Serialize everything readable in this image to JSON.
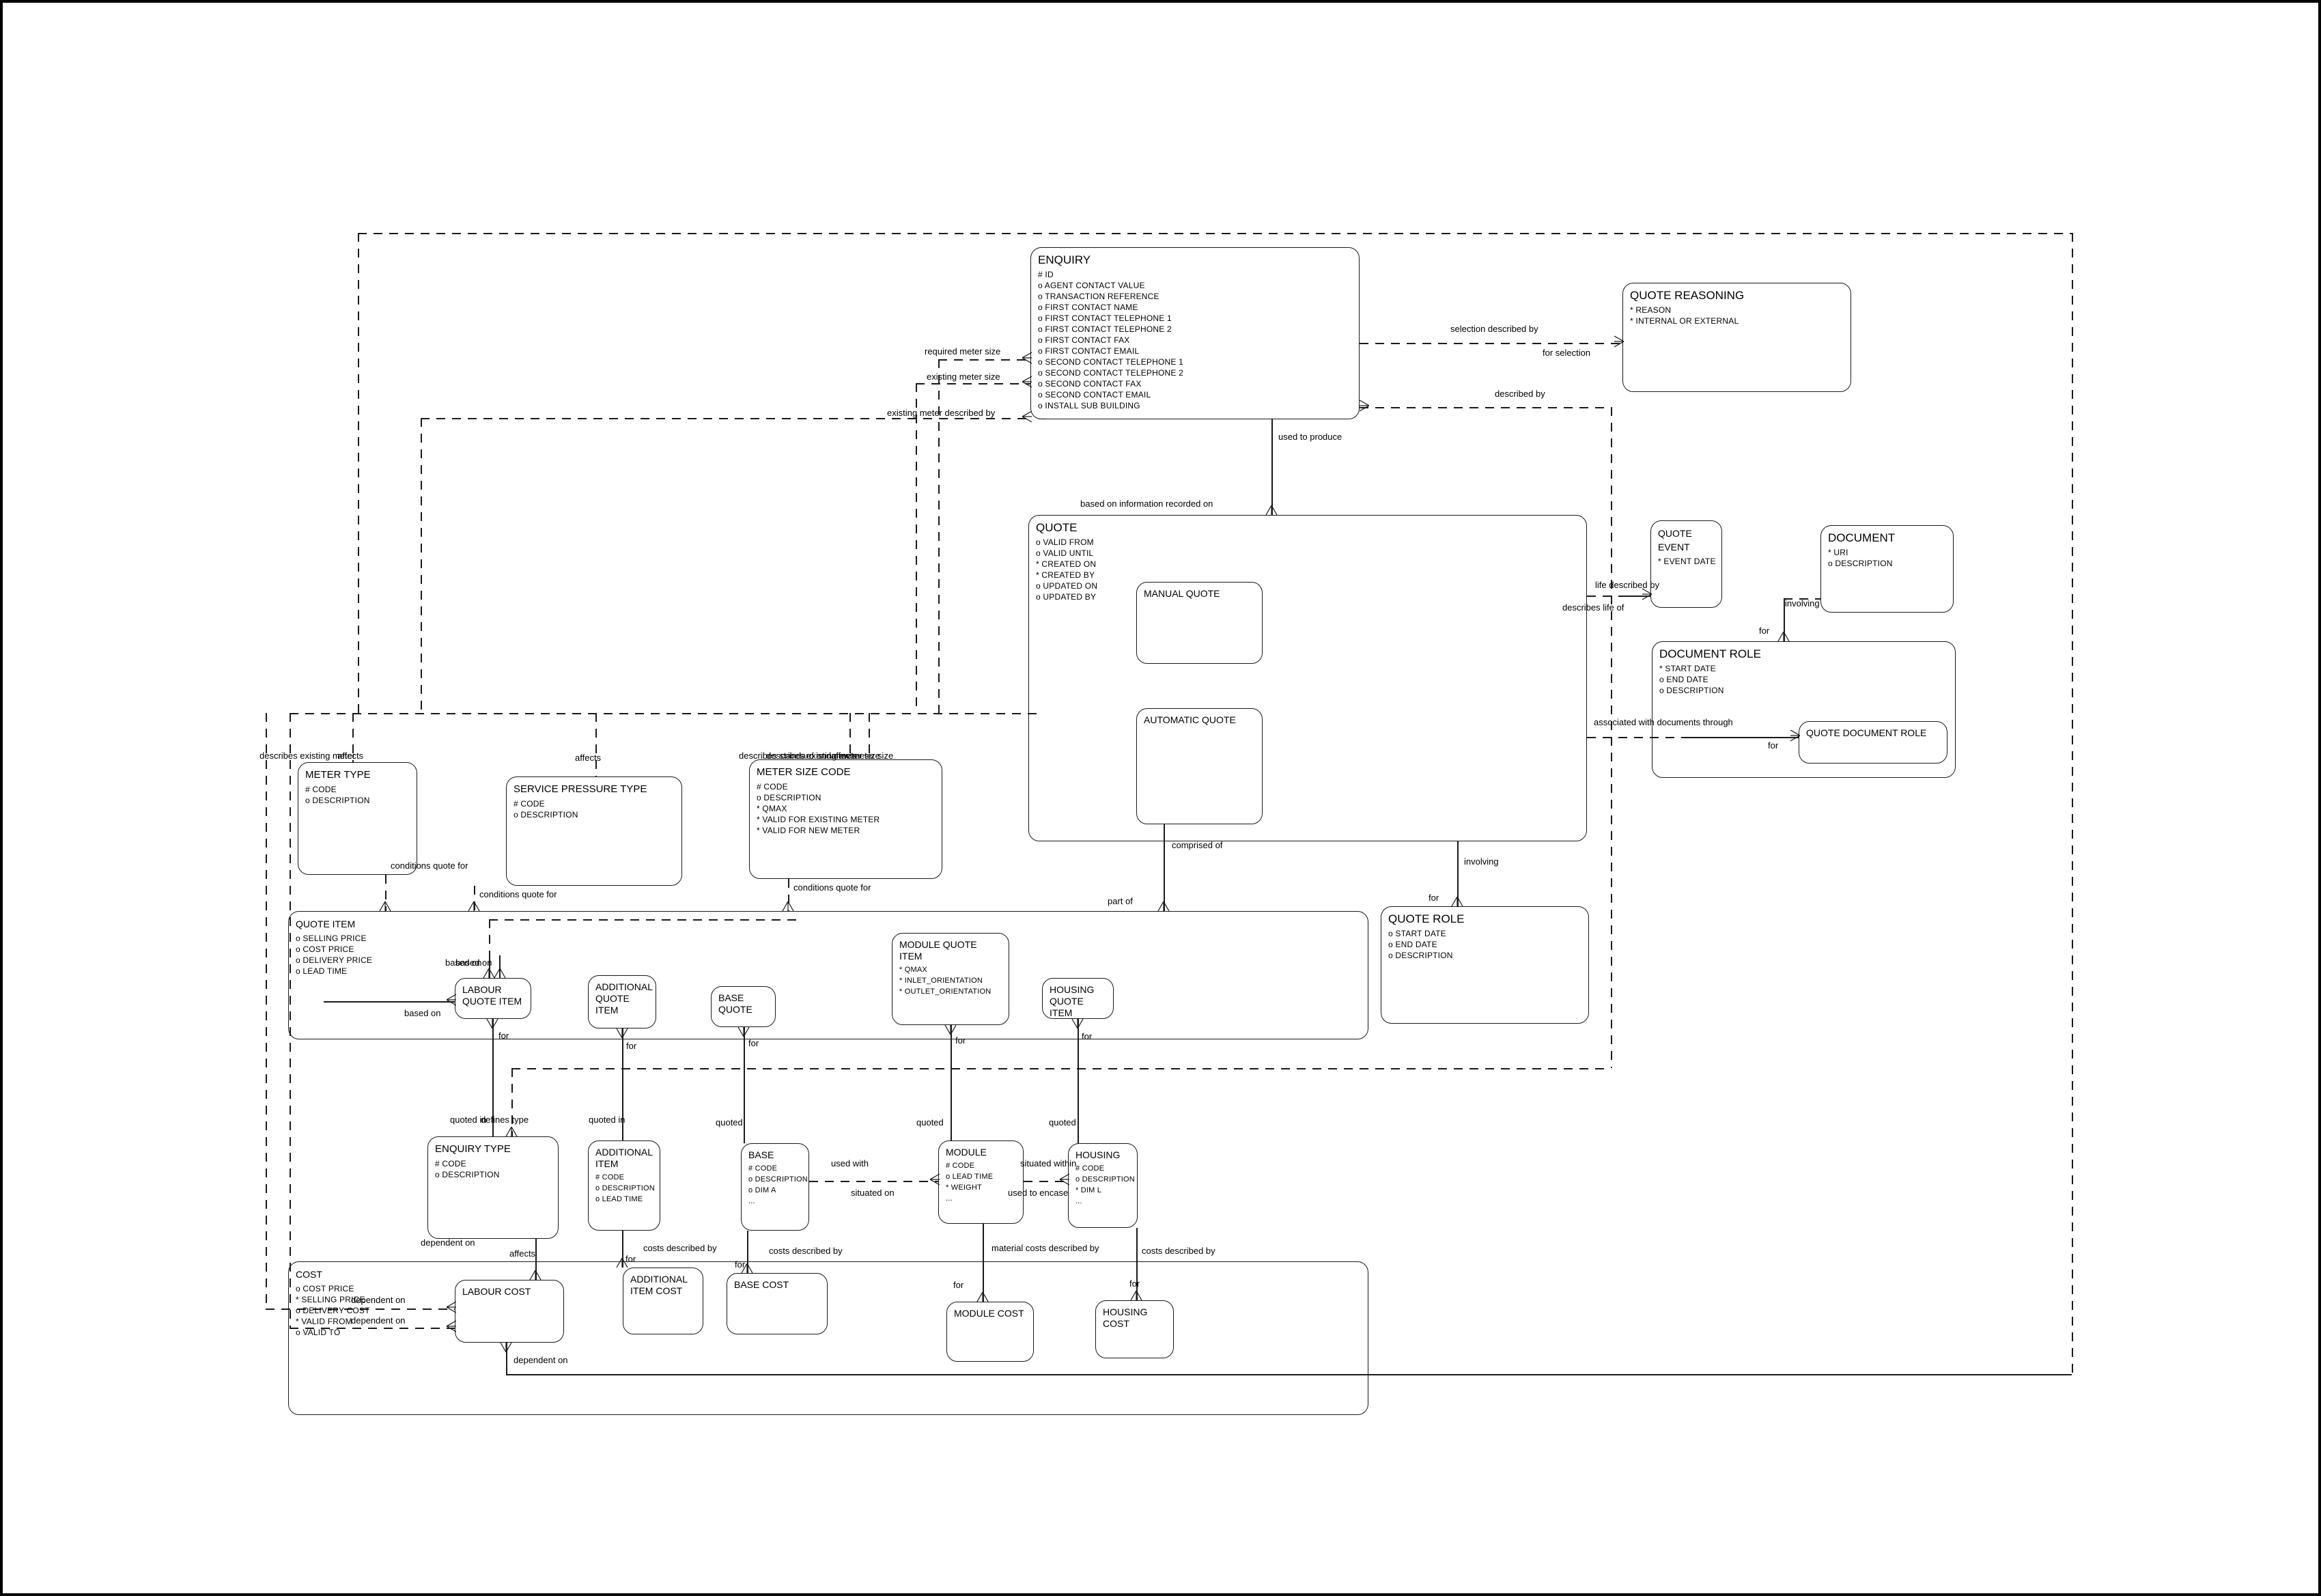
{
  "diagram_title": "Quote / Enquiry entity relationship diagram",
  "entities": {
    "enquiry": {
      "title": "ENQUIRY",
      "attrs": [
        "#  ID",
        "o  AGENT CONTACT VALUE",
        "o  TRANSACTION REFERENCE",
        "o  FIRST CONTACT NAME",
        "o  FIRST CONTACT TELEPHONE 1",
        "o  FIRST CONTACT TELEPHONE 2",
        "o  FIRST CONTACT FAX",
        "o  FIRST CONTACT EMAIL",
        "o  SECOND CONTACT TELEPHONE 1",
        "o  SECOND CONTACT TELEPHONE 2",
        "o  SECOND CONTACT FAX",
        "o  SECOND CONTACT EMAIL",
        "o  INSTALL SUB BUILDING",
        "..."
      ]
    },
    "quote_reasoning": {
      "title": "QUOTE REASONING",
      "attrs": [
        "*  REASON",
        "*  INTERNAL OR EXTERNAL"
      ]
    },
    "quote": {
      "title": "QUOTE",
      "attrs": [
        "o  VALID FROM",
        "o  VALID UNTIL",
        "*  CREATED ON",
        "*  CREATED BY",
        "o  UPDATED ON",
        "o  UPDATED BY"
      ]
    },
    "manual_quote": {
      "title": "MANUAL QUOTE",
      "attrs": []
    },
    "automatic_quote": {
      "title": "AUTOMATIC QUOTE",
      "attrs": []
    },
    "quote_event": {
      "title": "QUOTE EVENT",
      "attrs": [
        "*  EVENT DATE"
      ]
    },
    "document": {
      "title": "DOCUMENT",
      "attrs": [
        "*  URI",
        "o  DESCRIPTION"
      ]
    },
    "document_role": {
      "title": "DOCUMENT ROLE",
      "attrs": [
        "*  START DATE",
        "o  END DATE",
        "o  DESCRIPTION"
      ]
    },
    "quote_document_role": {
      "title": "QUOTE DOCUMENT ROLE",
      "attrs": []
    },
    "quote_role": {
      "title": "QUOTE ROLE",
      "attrs": [
        "o  START DATE",
        "o  END DATE",
        "o  DESCRIPTION"
      ]
    },
    "meter_type": {
      "title": "METER TYPE",
      "attrs": [
        "#  CODE",
        "o  DESCRIPTION"
      ]
    },
    "service_pressure_type": {
      "title": "SERVICE PRESSURE TYPE",
      "attrs": [
        "#  CODE",
        "o  DESCRIPTION"
      ]
    },
    "meter_size_code": {
      "title": "METER SIZE CODE",
      "attrs": [
        "#  CODE",
        "o  DESCRIPTION",
        "*  QMAX",
        "*  VALID FOR EXISTING METER",
        "*  VALID FOR NEW METER"
      ]
    },
    "quote_item": {
      "title": "QUOTE ITEM",
      "attrs": [
        "o  SELLING PRICE",
        "o  COST PRICE",
        "o  DELIVERY PRICE",
        "o  LEAD TIME"
      ]
    },
    "labour_quote_item": {
      "title": "LABOUR QUOTE ITEM",
      "attrs": []
    },
    "additional_quote_item": {
      "title": "ADDITIONAL QUOTE ITEM",
      "attrs": []
    },
    "base_quote": {
      "title": "BASE QUOTE",
      "attrs": []
    },
    "module_quote_item": {
      "title": "MODULE QUOTE ITEM",
      "attrs": [
        "*  QMAX",
        "*  INLET_ORIENTATION",
        "*  OUTLET_ORIENTATION"
      ]
    },
    "housing_quote_item": {
      "title": "HOUSING QUOTE ITEM",
      "attrs": []
    },
    "enquiry_type": {
      "title": "ENQUIRY TYPE",
      "attrs": [
        "#  CODE",
        "o  DESCRIPTION"
      ]
    },
    "additional_item": {
      "title": "ADDITIONAL ITEM",
      "attrs": [
        "#  CODE",
        "o  DESCRIPTION",
        "o  LEAD TIME"
      ]
    },
    "base": {
      "title": "BASE",
      "attrs": [
        "#  CODE",
        "o  DESCRIPTION",
        "o  DIM A",
        "..."
      ]
    },
    "module": {
      "title": "MODULE",
      "attrs": [
        "#  CODE",
        "o  LEAD TIME",
        "*  WEIGHT",
        "..."
      ]
    },
    "housing": {
      "title": "HOUSING",
      "attrs": [
        "#  CODE",
        "o  DESCRIPTION",
        "*  DIM L",
        "..."
      ]
    },
    "cost": {
      "title": "COST",
      "attrs": [
        "o  COST PRICE",
        "*  SELLING PRICE",
        "o  DELIVERY COST",
        "*  VALID FROM",
        "o  VALID TO"
      ]
    },
    "labour_cost": {
      "title": "LABOUR COST",
      "attrs": []
    },
    "additional_item_cost": {
      "title": "ADDITIONAL ITEM COST",
      "attrs": []
    },
    "base_cost": {
      "title": "BASE COST",
      "attrs": []
    },
    "module_cost": {
      "title": "MODULE COST",
      "attrs": []
    },
    "housing_cost": {
      "title": "HOUSING COST",
      "attrs": []
    }
  },
  "labels": {
    "selection_described_by": "selection described by",
    "for_selection": "for selection",
    "described_by": "described by",
    "used_to_produce": "used to produce",
    "based_on_info": "based on information recorded on",
    "required_meter_size": "required meter size",
    "existing_meter_size": "existing meter size",
    "existing_meter_described_by": "existing meter described by",
    "life_described_by": "life described by",
    "describes_life_of": "describes life of",
    "involving_doc": "involving",
    "for_doc": "for",
    "assoc_docs": "associated with documents through",
    "for_qdr": "for",
    "comprised_of": "comprised of",
    "part_of": "part of",
    "involving_role": "involving",
    "for_role": "for",
    "describes_existing_meter": "describes existing meter",
    "affects_mt": "affects",
    "affects_spt": "affects",
    "affects_msc": "affects",
    "describes_standard_meter_size": "describes standard and new meter size",
    "describes_existing_meter_size": "describes existing meter size",
    "conditions_quote_for_mt": "conditions quote for",
    "conditions_quote_for_spt": "conditions quote for",
    "conditions_quote_for_msc": "conditions quote for",
    "based_on_1": "based on",
    "based_on_2": "based on",
    "based_on_3": "based on",
    "for_lqi": "for",
    "for_aqi": "for",
    "for_bq": "for",
    "for_mqi": "for",
    "for_hqi": "for",
    "quoted_in_et": "quoted in",
    "defines_type": "defines type",
    "quoted_in_ai": "quoted in",
    "quoted_b": "quoted",
    "quoted_m": "quoted",
    "quoted_h": "quoted",
    "used_with": "used with",
    "situated_on": "situated on",
    "situated_within": "situated within",
    "used_to_encase": "used to encase",
    "affects_et": "affects",
    "dependent_on_et": "dependent on",
    "costs_described_by_ai": "costs described by",
    "costs_described_by_b": "costs described by",
    "material_costs_described_by": "material costs described by",
    "costs_described_by_h": "costs described by",
    "for_aic": "for",
    "for_bc": "for",
    "for_mc": "for",
    "for_hc": "for",
    "dependent_on_l1": "dependent on",
    "dependent_on_l2": "dependent on",
    "dependent_on_bottom": "dependent on"
  }
}
